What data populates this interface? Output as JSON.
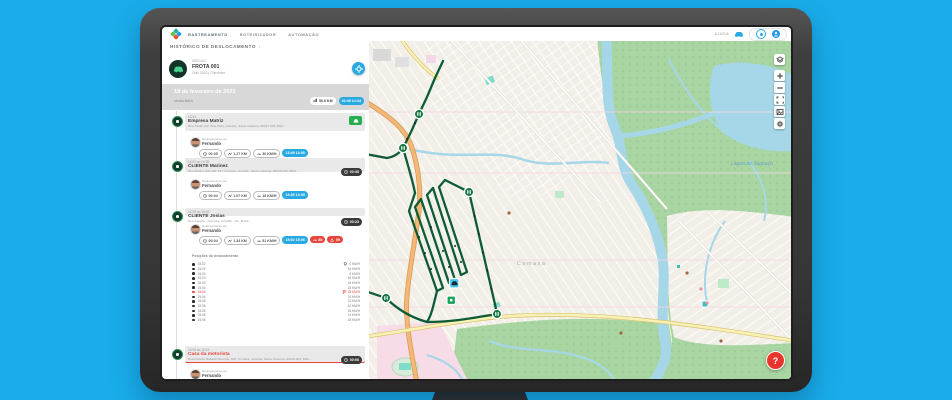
{
  "topbar": {
    "menu": [
      "RASTREAMENTO",
      "ROTEIRIZADOR",
      "AUTOMAÇÃO"
    ],
    "help_label": "AJUDA"
  },
  "breadcrumb": "HISTÓRICO DE DESLOCAMENTO",
  "vehicle": {
    "kind": "VEÍCULO",
    "name": "FROTA 001",
    "model": "Onix 2020 | Chevrolet"
  },
  "date_header": {
    "date": "19 de fevereiro de 2021",
    "weekday": "sexta-feira",
    "distance": "50.6 KM",
    "time_range": "02:49  14:34"
  },
  "timeline": [
    {
      "time": "13:49",
      "title": "Empresa Matriz",
      "address": "Rua Xavier Arp, Boa Vista, Joinville, Santa Catarina, 89227-653, BRA...",
      "action": "route",
      "trip": {
        "by": "Deslocamento por",
        "driver": "Fernando",
        "duration": "00:05",
        "distance": "1.27 KM",
        "speed": "30 KM/H",
        "range": "13:49  14:00",
        "alerts": []
      }
    },
    {
      "time": "14:00 ao 14:35",
      "title": "CLIENTE Marinez",
      "address": "Rua Albano Schmidt, 517, Comasa, Joinville, Santa Catarina, 89229-076, BRA...",
      "duration": "00:35",
      "trip": {
        "by": "Deslocamento por",
        "driver": "Fernando",
        "duration": "00:04",
        "distance": "1.07 KM",
        "speed": "18 KM/H",
        "range": "14:35  14:39",
        "alerts": []
      }
    },
    {
      "time": "14:39 ao 15:02",
      "title": "CLIENTE Josias",
      "address": "Rua Itaperiú - Comasa, Joinville - SC, Brasil...",
      "duration": "00:23",
      "trip": {
        "by": "Deslocamento por",
        "driver": "Fernando",
        "duration": "00:04",
        "distance": "1.34 KM",
        "speed": "51 KM/H",
        "range": "15:02  15:06",
        "alerts": [
          {
            "icon": "gauge-icon",
            "value": "85"
          },
          {
            "icon": "alert-icon",
            "value": "09"
          }
        ]
      }
    },
    {
      "time": "15:06 ao 15:12",
      "title": "Casa da motorista",
      "address": "Rua Prefeito Baltazar Buschle, 825, Comasa, Joinville, Santa Catarina, 89229-300, BRA...",
      "duration": "00:06",
      "red": true,
      "trip": {
        "by": "Deslocamento por",
        "driver": "Fernando"
      }
    }
  ],
  "positions": {
    "title": "Posições do deslocamento",
    "rows": [
      {
        "time": "15:02",
        "speed": "0 KM/H",
        "icon": "pin-icon"
      },
      {
        "time": "15:02",
        "speed": "18 KM/H"
      },
      {
        "time": "15:03",
        "speed": "9 KM/H"
      },
      {
        "time": "15:03",
        "speed": "18 KM/H"
      },
      {
        "time": "15:03",
        "speed": "16 KM/H"
      },
      {
        "time": "15:04",
        "speed": "18 KM/H"
      },
      {
        "time": "15:04",
        "speed": "78 KM/H",
        "alert": true,
        "icon": "flag-icon"
      },
      {
        "time": "15:04",
        "speed": "24 KM/H"
      },
      {
        "time": "15:05",
        "speed": "31 KM/H"
      },
      {
        "time": "15:05",
        "speed": "14 KM/H"
      },
      {
        "time": "15:05",
        "speed": "16 KM/H"
      },
      {
        "time": "15:06",
        "speed": "14 KM/H"
      },
      {
        "time": "15:06",
        "speed": "18 KM/H"
      }
    ]
  },
  "map": {
    "controls": [
      "layers-icon",
      "zoom-in-icon",
      "zoom-out-icon",
      "fullscreen-icon",
      "satellite-icon",
      "settings-icon"
    ],
    "help": "?",
    "labels": {
      "water": "Lagoa do Saguaçu",
      "district": "Comasa"
    }
  },
  "colors": {
    "accent_blue": "#29a9e2",
    "route_green": "#0d5c35",
    "alert_red": "#e7453f",
    "background": "#19adeb"
  }
}
